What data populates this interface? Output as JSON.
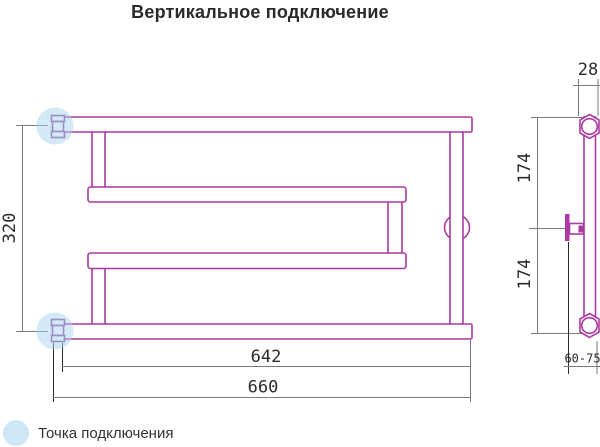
{
  "title": "Вертикальное подключение",
  "legend": {
    "label": "Точка подключения"
  },
  "colors": {
    "tube_outline": "#ac39a2",
    "fitting_outline": "#8a4897",
    "connection_highlight": "#aad4f0",
    "dimension_line": "#7a7a7a",
    "extension_line": "#2b2b2b",
    "text": "#2b2b2b"
  },
  "front_view": {
    "dims": {
      "height_mm": "320",
      "width_axes_mm": "642",
      "width_overall_mm": "660"
    }
  },
  "side_view": {
    "dims": {
      "depth_mm": "28",
      "top_span_mm": "174",
      "bottom_span_mm": "174",
      "wall_offset_mm": "60-75"
    }
  }
}
